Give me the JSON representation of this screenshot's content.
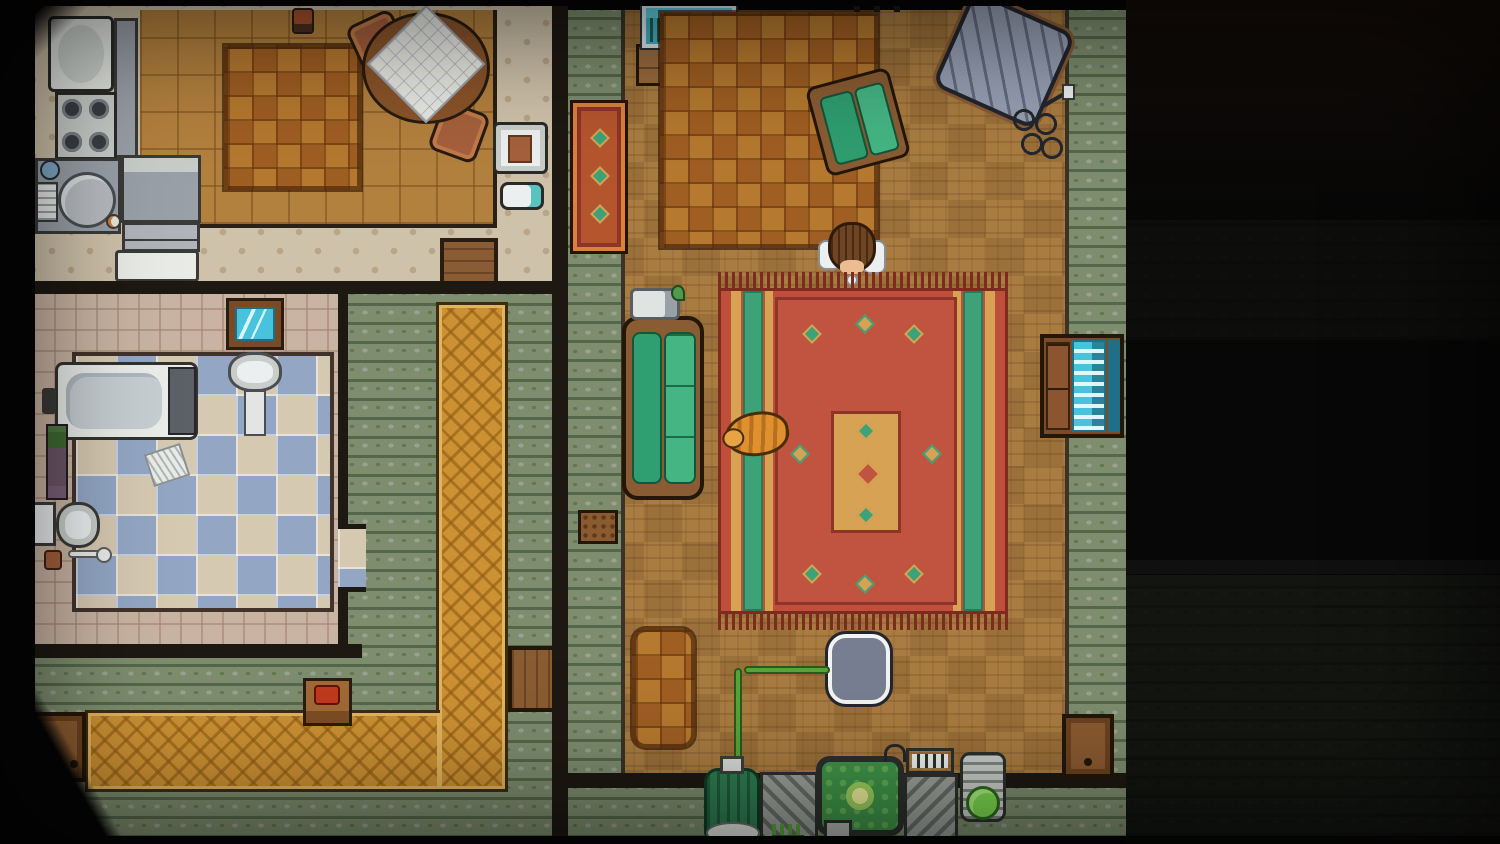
{
  "app": {
    "name": "Top-down pixel-art apartment game",
    "visible_text": []
  },
  "palette": {
    "vignette": "#060606",
    "wall": "#1d1811",
    "kitchen_floor": "#b3813e",
    "dotted_floor": "#cfc2aa",
    "parquet": "#a97c41",
    "hall_carpet": "#7d8d6e",
    "runner_orange": "#cc9133",
    "tile_blue": "#93a7c4",
    "tile_beige": "#d6c9b2",
    "pink_tile": "#c9b4a3",
    "rug_red": "#bf4e3a",
    "rug_green_stripe": "#3da277",
    "rug_gold": "#d8a254",
    "rug_fringe": "#7e2b1f",
    "couch_green": "#2f9e70",
    "wood": "#8a5c33",
    "appliance_gray": "#9aa0a8",
    "machine_green": "#3f9447",
    "goo_green": "#7cd84f",
    "aquarium_teal": "#3fb3c9",
    "cat_orange": "#e0912f",
    "tv_screen": "#49c2dd",
    "door_brown": "#8a5a30"
  },
  "rooms": {
    "kitchen": {
      "label": "Kitchen"
    },
    "bathroom": {
      "label": "Bathroom"
    },
    "hallway": {
      "label": "Hallway"
    },
    "living_room": {
      "label": "Living room"
    },
    "dark_area": {
      "label": "Unlit area"
    }
  },
  "labels": {
    "fridge": "Refrigerator",
    "counter": "Kitchen counter",
    "stove": "Gas stove with four burners",
    "sink": "Kitchen sink with dish rack",
    "drawers": "Counter drawers",
    "washer": "Dishwasher",
    "kitchen_rug": "Checkered kitchen rug",
    "dining_table": "Round dining table with white cloth",
    "chair": "Dining chair",
    "plant": "Potted plant",
    "high_chair": "High chair",
    "potty": "Baby potty",
    "aquarium": "Aquarium with frogs",
    "aquarium_stand": "Aquarium cabinet",
    "brown_rug": "Brown checkered rug",
    "armchair": "Green armchair",
    "reading_chair": "Tilted upholstered chair",
    "cable": "Tangled cord",
    "outlet": "Wall outlet",
    "couch": "Green sofa",
    "gadget": "White gadget on sofa arm",
    "red_rug": "Large ornamental red rug",
    "cat": "Sleeping orange cat",
    "character": "Character in white shirt",
    "tv_cabinet": "Cabinet with glowing screen",
    "ornate_rug": "Small ornate rug",
    "floor_item": "Small mat on carpet",
    "small_rug": "Small checkered runner",
    "pad": "Rounded floor pad",
    "hose": "Green hose",
    "canister": "Green canister",
    "machine": "Strange machine",
    "vat": "Glowing green vat",
    "goo": "Container of green goo",
    "grill": "Vent unit",
    "east_door": "Door (east wall)",
    "front_door": "Front door",
    "hall_door": "Doorway to living room",
    "kitchen_door": "Doorway to hallway",
    "bath_door": "Doorway to bathroom",
    "phone_table": "Telephone table",
    "telephone": "Red telephone",
    "mirror": "Bathroom mirror",
    "bath_sink": "Pedestal sink",
    "bathtub": "Bathtub",
    "shelf": "Shelf with plants",
    "toilet": "Toilet",
    "plunger": "Plunger",
    "slippers": "Slippers",
    "towel": "Crumpled bath towel",
    "runner": "Diamond-pattern runner rug",
    "hooks": "Wall pegs"
  }
}
